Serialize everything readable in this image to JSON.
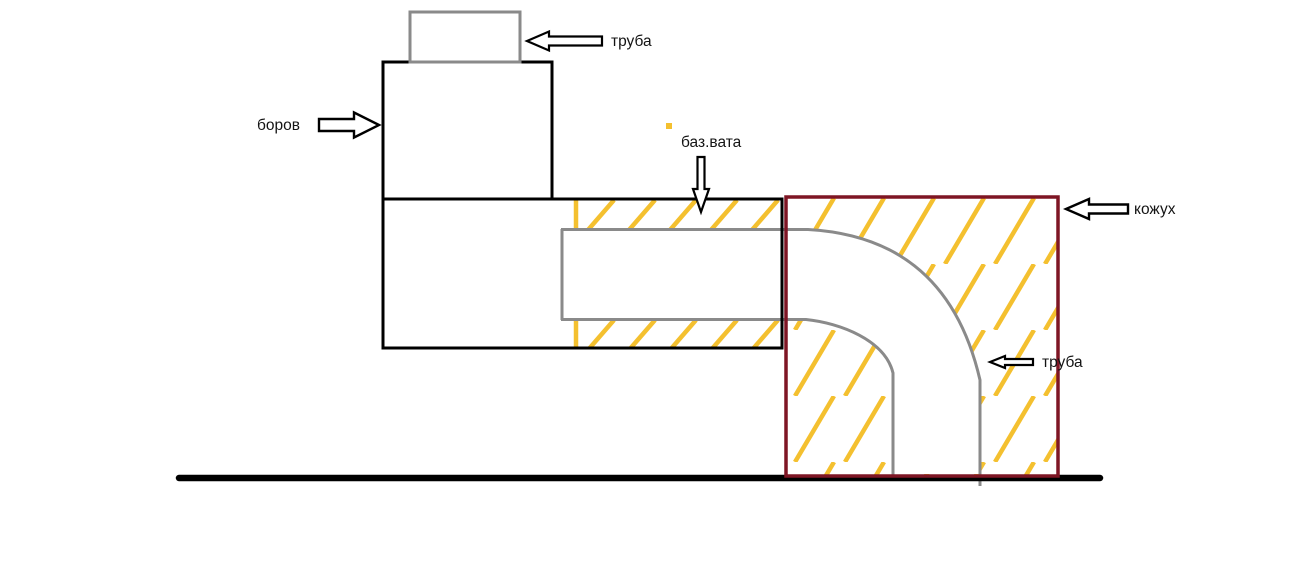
{
  "labels": {
    "pipe_top": "труба",
    "flue": "боров",
    "insulation": "баз.вата",
    "casing": "кожух",
    "pipe_bend": "труба"
  },
  "colors": {
    "background": "#ffffff",
    "line_black": "#000000",
    "pipe_gray": "#8a8a8a",
    "insulation_yellow": "#f4c02f",
    "casing_dark_red": "#7e1524"
  },
  "arrows": {
    "pipe_top": "left-block-arrow",
    "flue": "right-block-arrow",
    "insulation": "down-block-arrow",
    "casing": "left-block-arrow",
    "pipe_bend": "left-block-arrow"
  }
}
